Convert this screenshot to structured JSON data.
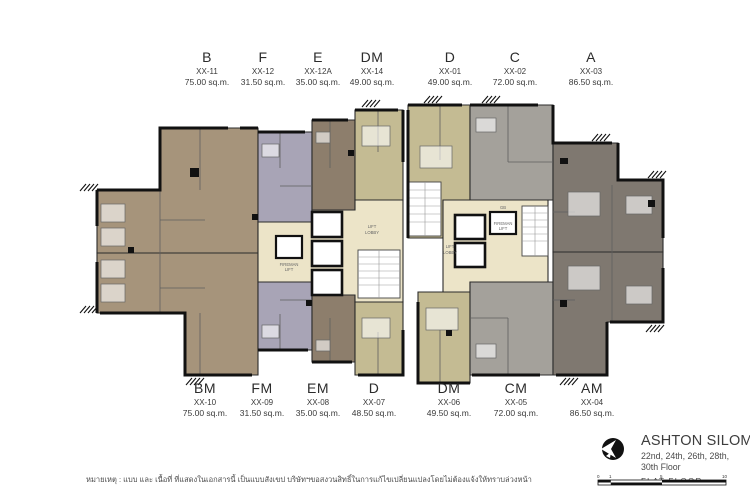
{
  "colors": {
    "brown": "#a6947b",
    "lavender": "#a8a4b6",
    "taupe": "#8d7e6c",
    "khaki": "#c4bb93",
    "gray": "#a4a19b",
    "dark": "#7f7870",
    "cream": "#ece4c8",
    "wall": "#111111"
  },
  "units_top": [
    {
      "type": "B",
      "no": "XX-11",
      "area": "75.00 sq.m.",
      "color": "#a6947b"
    },
    {
      "type": "F",
      "no": "XX-12",
      "area": "31.50 sq.m.",
      "color": "#a8a4b6"
    },
    {
      "type": "E",
      "no": "XX-12A",
      "area": "35.00 sq.m.",
      "color": "#8d7e6c"
    },
    {
      "type": "DM",
      "no": "XX-14",
      "area": "49.00 sq.m.",
      "color": "#c4bb93"
    },
    {
      "type": "D",
      "no": "XX-01",
      "area": "49.00 sq.m.",
      "color": "#c4bb93"
    },
    {
      "type": "C",
      "no": "XX-02",
      "area": "72.00 sq.m.",
      "color": "#a4a19b"
    },
    {
      "type": "A",
      "no": "XX-03",
      "area": "86.50 sq.m.",
      "color": "#7f7870"
    }
  ],
  "units_bottom": [
    {
      "type": "BM",
      "no": "XX-10",
      "area": "75.00 sq.m.",
      "color": "#a6947b"
    },
    {
      "type": "FM",
      "no": "XX-09",
      "area": "31.50 sq.m.",
      "color": "#a8a4b6"
    },
    {
      "type": "EM",
      "no": "XX-08",
      "area": "35.00 sq.m.",
      "color": "#8d7e6c"
    },
    {
      "type": "D",
      "no": "XX-07",
      "area": "48.50 sq.m.",
      "color": "#c4bb93"
    },
    {
      "type": "DM",
      "no": "XX-06",
      "area": "49.50 sq.m.",
      "color": "#c4bb93"
    },
    {
      "type": "CM",
      "no": "XX-05",
      "area": "72.00 sq.m.",
      "color": "#a4a19b"
    },
    {
      "type": "AM",
      "no": "XX-04",
      "area": "86.50 sq.m.",
      "color": "#7f7870"
    }
  ],
  "core": {
    "lift_l1": "LIFT",
    "lift_l2": "LOBBY",
    "fireman_l1": "FIREMAN",
    "fireman_l2": "LIFT",
    "gb": "GB"
  },
  "title_block": {
    "project": "ASHTON SILOM",
    "floors_line1": "22nd, 24th, 26th, 28th,",
    "floors_line2": "30th Floor",
    "plan_type": "FLAT FLOOR"
  },
  "scale_bar": {
    "labels": [
      "0",
      "1",
      "5",
      "10"
    ]
  },
  "footnote": "หมายเหตุ : แบบ และ เนื้อที่ ที่แสดงในเอกสารนี้ เป็นแบบสังเขป บริษัทฯขอสงวนสิทธิ์ในการแก้ไขเปลี่ยนแปลงโดยไม่ต้องแจ้งให้ทราบล่วงหน้า"
}
